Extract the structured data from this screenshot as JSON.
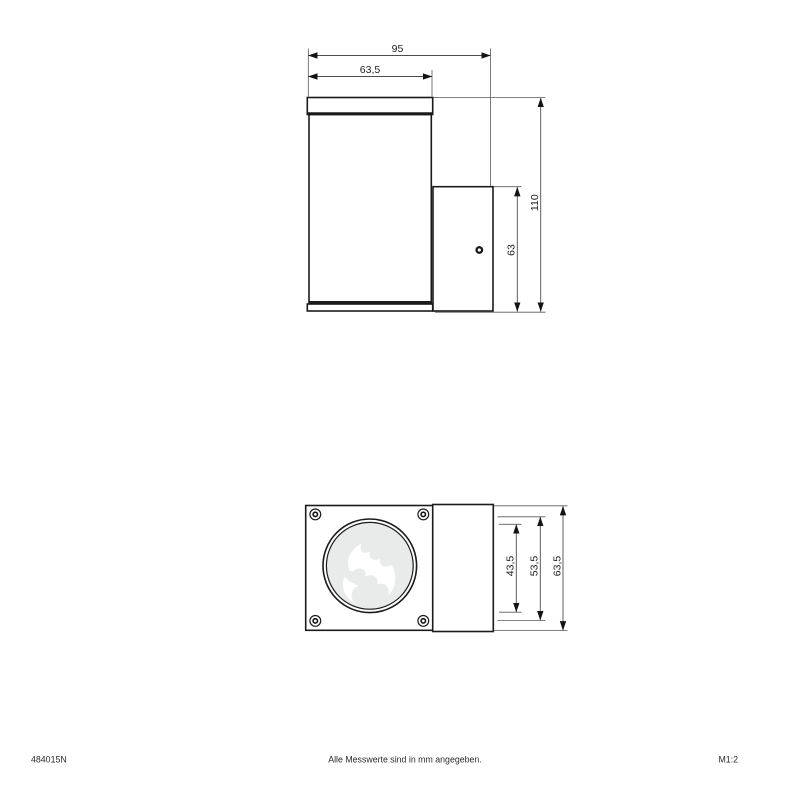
{
  "footer": {
    "article_number": "484015N",
    "note": "Alle Messwerte sind in mm angegeben.",
    "scale": "M1:2"
  },
  "side_view": {
    "dims": {
      "total_width": "95",
      "body_width": "63,5",
      "total_height": "110",
      "bracket_height": "63"
    }
  },
  "front_view": {
    "dims": {
      "lens_diameter": "43,5",
      "screw_spacing": "53,5",
      "plate_size": "63,5"
    }
  },
  "colors": {
    "background": "#ffffff",
    "object_line": "#1b1b1b",
    "dimension_line": "#4d4d4d",
    "lens_fill": "#e9eaea"
  }
}
